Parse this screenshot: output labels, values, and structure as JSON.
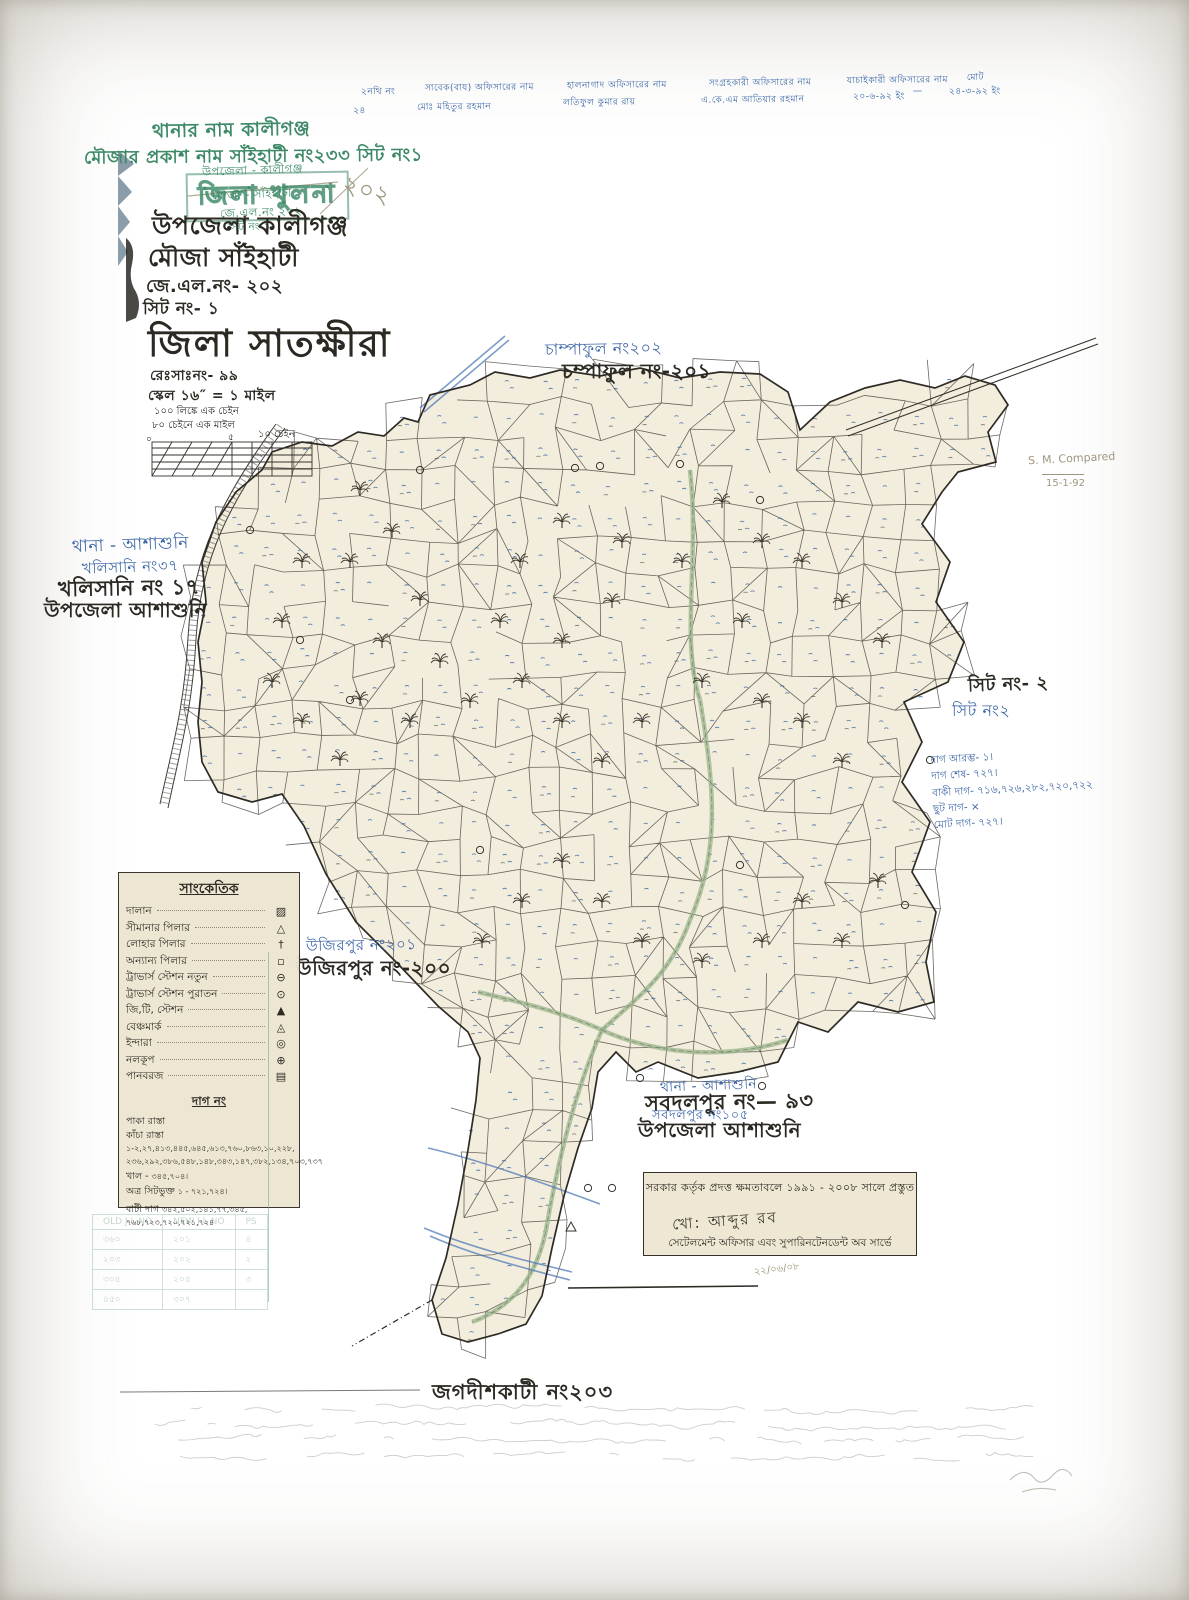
{
  "header": {
    "thana_green": "থানার নাম কালীগঞ্জ",
    "mouza_green": "মৌজার প্রকাশ নাম সাঁইহাটী নং২৩৩ সিট নং১",
    "stamp_upazila": "উপজেলা - কালীগঞ্জ",
    "stamp_district": "জিলা খুলনা",
    "stamp_mouza": "মৌজা - সাঁইহাটী",
    "stamp_jl": "জে.এল.নং ২০২",
    "stamp_sheet": "সিট নং ১",
    "pencil_number": "২০২",
    "upazila": "উপজেলা কালীগঞ্জ",
    "mouza": "মৌজা সাঁইহাটী",
    "jl_no": "জে.এল.নং- ২০২",
    "sheet_no": "সিট নং- ১",
    "district": "জিলা সাতক্ষীরা",
    "reg_no": "রেঃসাঃনং- ৯৯",
    "scale": "স্কেল ১৬″ = ১ মাইল"
  },
  "top_table": {
    "r1c1": "২নথি নং",
    "r1c2": "সাবেক(বায) অফিসারের নাম",
    "r1c3": "হালনাগাদ অফিসারের নাম",
    "r1c4": "সংগ্রহকারী অফিসারের নাম",
    "r1c5": "যাচাইকারী অফিসারের নাম",
    "r1c6": "মোট",
    "r2c1": "২৪",
    "r2c2": "মোঃ মহিতুর রহমান",
    "r2c3": "লতিফুল কুমার রায়",
    "r2c4": "এ.কে.এম আতিয়ার রহমান",
    "r2c5": "২০-৬-৯২ ইং",
    "r2c6": "—",
    "r2c7": "২৪-৩-৯২ ইং"
  },
  "scalebar": {
    "line1": "১০০ লিঙ্কে এক চেইন",
    "line2": "৮০ চেইনে এক মাইল",
    "unit": "১০ চেইন",
    "zero": "০",
    "mid": "৫"
  },
  "neighbors": {
    "champaful_blue": "চাম্পাফুল নং২০২",
    "champaful_black": "চম্পাফুল নং-২০১",
    "west_thana": "থানা - আশাশুনি",
    "khalisani_blue": "খলিসানি নং৩৭",
    "khalisani_black": "খলিসানি নং ১৭",
    "west_upazila": "উপজেলা আশাশুনি",
    "sheet2_black": "সিট নং- ২",
    "sheet2_blue": "সিট নং২",
    "ujirpur_blue": "উজিরপুর নং২০১",
    "ujirpur_black": "উজিরপুর নং-২০০",
    "south_thana": "থানা - আশাশুনি",
    "sabdalpur_black": "সবদলপুর নং— ৯৩",
    "sabdalpur_blue": "সবদলপুর নং১০৫",
    "south_upazila": "উপজেলা আশাশুনি",
    "jagadishkati": "জগদীশকাটী নং২০৩"
  },
  "notes": {
    "l1": "দাগ আরম্ভ- ১।",
    "l2": "দাগ শেষ- ৭২৭।",
    "l3": "বাকী দাগ- ৭১৬,৭২৬,২৮২,৭২০,৭২২",
    "l4": "ছুট দাগ- ×",
    "l5": "মোট দাগ- ৭২৭।"
  },
  "pencil": {
    "compared": "S. M. Compared",
    "date": "15-1-92",
    "cert_date": "২২/০৬/০৮"
  },
  "legend": {
    "title": "সাংকেতিক",
    "items": [
      {
        "label": "দালান",
        "glyph": "▨"
      },
      {
        "label": "সীমানার পিলার",
        "glyph": "△"
      },
      {
        "label": "লোহার পিলার",
        "glyph": "†"
      },
      {
        "label": "অন্যান্য পিলার",
        "glyph": "▫"
      },
      {
        "label": "ট্রাভার্স স্টেশন নতুন",
        "glyph": "⊖"
      },
      {
        "label": "ট্রাভার্স স্টেশন পুরাতন",
        "glyph": "⊙"
      },
      {
        "label": "জি,টি, স্টেশন",
        "glyph": "▲"
      },
      {
        "label": "বেঞ্চমার্ক",
        "glyph": "◬"
      },
      {
        "label": "ইন্দারা",
        "glyph": "◎"
      },
      {
        "label": "নলকূপ",
        "glyph": "⊕"
      },
      {
        "label": "পানবরজ",
        "glyph": "▤"
      }
    ]
  },
  "dag": {
    "title": "দাগ নং",
    "rows": [
      {
        "label": "পাকা রাস্তা",
        "value": ""
      },
      {
        "label": "কাঁচা রাস্তা",
        "value": "১-২,২৭,৪১৩,৪৪৫,৬৪৫,৬১৩,৭৬০,৮৬৩,১০,২২৮, ২৩৬,২৯২,৩৮৬,৫৪৮,১৪৮,৩৪৩,১৪৭,৩৮২,১৩৪,৭০৩,৭৩৭"
      },
      {
        "label": "খাল",
        "value": "৩৪৫,৭০৪।"
      },
      {
        "label": "অত্র সিটভুক্ত",
        "value": "১ - ৭২১,৭২৪।"
      },
      {
        "label": "বাটী দাগ",
        "value": "৩৪২,৫০২,১৪১,৭৭,৩৪৫, ৭৬৮,৭২৩,৭২০,৭২১,৭২৪"
      }
    ]
  },
  "certificate": {
    "line1": "সরকার কর্তৃক প্রদত্ত ক্ষমতাবলে ১৯৯১ - ২০০৮ সালে প্রস্তুত",
    "sig": "খো: আব্দুর রব",
    "line2": "সেটেলমেন্ট অফিসার এবং সুপারিনটেনডেন্ট অব সার্ভে"
  },
  "jl_table": {
    "h1": "OLD J L NO",
    "h2": "NEW J L NO",
    "h3": "PS",
    "rows": [
      [
        "৩৬০",
        "২০১",
        "৪"
      ],
      [
        "২০৩",
        "২০২",
        "২"
      ],
      [
        "৩০৪",
        "২০৫",
        "৩"
      ],
      [
        "৪৫০",
        "৩০৭",
        ""
      ]
    ]
  },
  "colors": {
    "paper": "#e8dfc7",
    "black_ink": "#2c2922",
    "blue_ink": "#3b66a6",
    "green_ink": "#3e8a68",
    "pencil": "#a0967f"
  }
}
